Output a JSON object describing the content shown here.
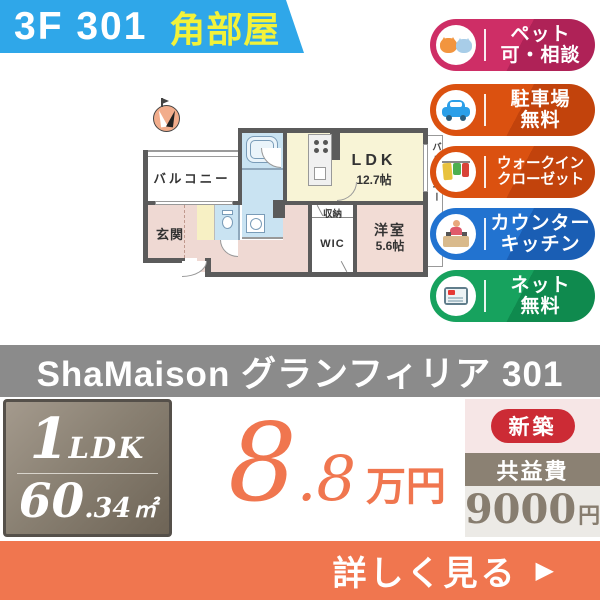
{
  "header": {
    "unit": "3F 301",
    "corner": "角部屋"
  },
  "badges": [
    {
      "name": "pets-ok",
      "icon": "dog-cat-icon",
      "lines": [
        "ペット",
        "可・相談"
      ]
    },
    {
      "name": "parking-free",
      "icon": "car-icon",
      "lines": [
        "駐車場",
        "無料"
      ]
    },
    {
      "name": "walk-in-closet",
      "icon": "hanging-clothes-icon",
      "lines": [
        "ウォークイン",
        "クローゼット"
      ]
    },
    {
      "name": "counter-kitchen",
      "icon": "counter-kitchen-icon",
      "lines": [
        "カウンター",
        "キッチン"
      ]
    },
    {
      "name": "internet-free",
      "icon": "tablet-icon",
      "lines": [
        "ネット",
        "無料"
      ]
    }
  ],
  "floorplan": {
    "balcony_left": "バルコニー",
    "entrance": "玄関",
    "ldk_name": "LDK",
    "ldk_size": "12.7帖",
    "storage": "収納",
    "wic": "WIC",
    "bedroom_name": "洋室",
    "bedroom_size": "5.6帖",
    "balcony_right": "バルコニー",
    "compass": "north-compass-icon"
  },
  "title_bar": {
    "text": "ShaMaison グランフィリア 301"
  },
  "summary": {
    "layout_number": "1",
    "layout_type": "LDK",
    "area_int": "60",
    "area_decimal": ".34",
    "area_unit": "㎡"
  },
  "price": {
    "integer": "8",
    "decimal": ".8",
    "unit": "万円"
  },
  "tags": {
    "new_build": "新築",
    "fee_label": "共益費",
    "fee_value": "9000",
    "fee_unit": "円"
  },
  "cta": {
    "label": "詳しく見る",
    "arrow": "▶"
  },
  "colors": {
    "banner_blue": "#2FA7E9",
    "corner_yellow": "#F2F23A",
    "badge_pink": "#CE2E66",
    "badge_orange": "#DB5110",
    "badge_blue": "#2273D0",
    "badge_green": "#17A25E",
    "title_gray": "#8B8B8B",
    "price_orange": "#F0764F",
    "new_build_red": "#CC2B35",
    "fee_band_brown": "#8B8173",
    "fee_value_bg": "#ECEAE6",
    "summary_taupe": "#8A8173",
    "plan_wall": "#5B5B5B",
    "plan_cream": "#F8F4D6",
    "plan_pink": "#EFD9D3",
    "plan_blue": "#C9E3F2"
  }
}
